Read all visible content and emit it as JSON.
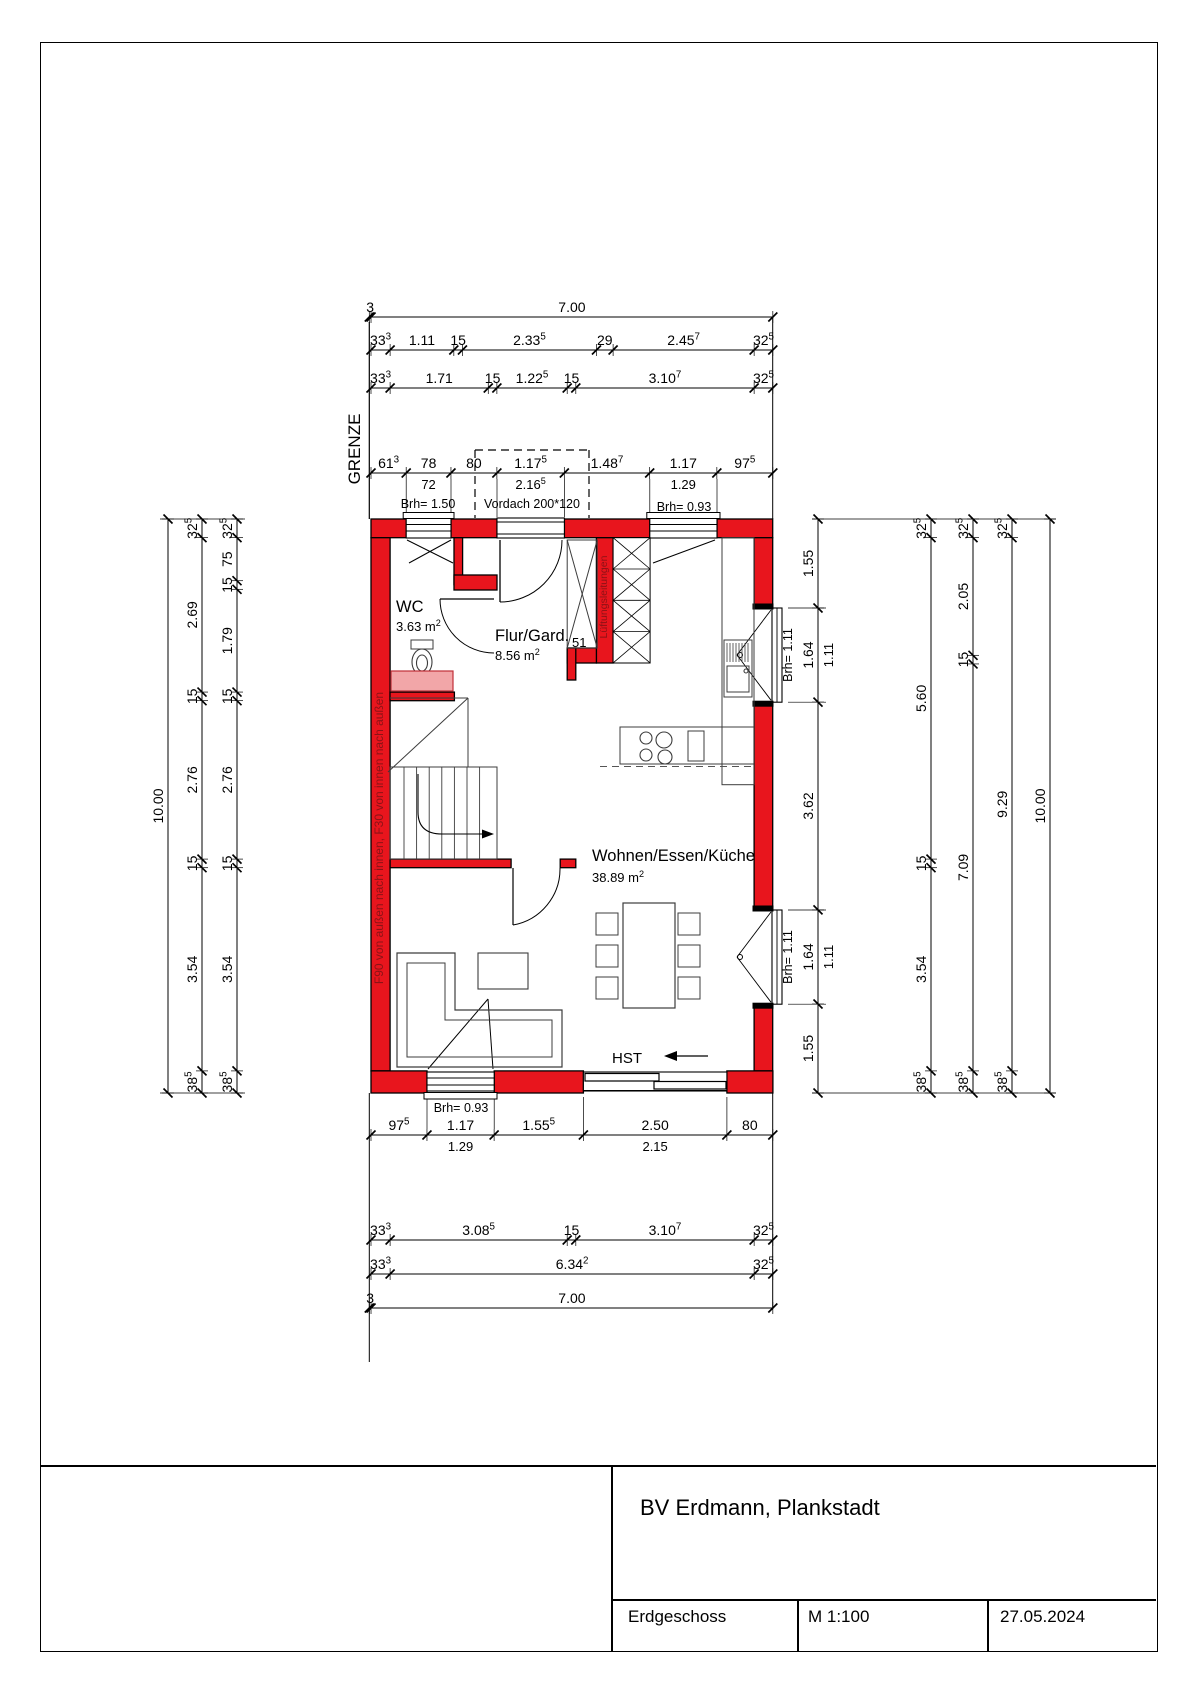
{
  "colors": {
    "wall_red": "#e8151d",
    "vanity_pink": "#f2a6a8",
    "annotation_red": "#8c1216",
    "line_black": "#000000",
    "furniture_gray": "#3c3c3c"
  },
  "floor_plan": {
    "rooms": [
      {
        "name": "WC",
        "area": "3.63 m²"
      },
      {
        "name": "Flur/Gard.",
        "area": "8.56 m²"
      },
      {
        "name": "Wohnen/Essen/Küche",
        "area": "38.89 m²"
      }
    ],
    "annotations": {
      "grenze": "GRENZE",
      "vordach": "Vordach 200*120",
      "hst": "HST",
      "gard_width": "51",
      "fire_note": "F90 von außen nach innen, F30 von innen nach außen",
      "duct_note": "Lüftungsleitungen",
      "brh_150": "Brh= 1.50",
      "brh_093_top": "Brh= 0.93",
      "brh_093_bottom": "Brh= 0.93",
      "brh_111_upper": "Brh= 1.11",
      "brh_111_lower": "Brh= 1.11"
    },
    "dimension_chains": [
      {
        "id": "T1",
        "segs": [
          {
            "t": "3",
            "v": 0.03
          },
          {
            "t": "7.00",
            "v": 7.0
          }
        ]
      },
      {
        "id": "T2",
        "segs": [
          {
            "t": "33³",
            "v": 0.333
          },
          {
            "t": "1.11",
            "v": 1.11
          },
          {
            "t": "15",
            "v": 0.15
          },
          {
            "t": "2.33⁵",
            "v": 2.335
          },
          {
            "t": "29",
            "v": 0.29
          },
          {
            "t": "2.45⁷",
            "v": 2.457
          },
          {
            "t": "32⁵",
            "v": 0.325
          }
        ]
      },
      {
        "id": "T3",
        "segs": [
          {
            "t": "33³",
            "v": 0.333
          },
          {
            "t": "1.71",
            "v": 1.71
          },
          {
            "t": "15",
            "v": 0.15
          },
          {
            "t": "1.22⁵",
            "v": 1.225
          },
          {
            "t": "15",
            "v": 0.15
          },
          {
            "t": "3.10⁷",
            "v": 3.107
          },
          {
            "t": "32⁵",
            "v": 0.325
          }
        ]
      },
      {
        "id": "T4",
        "segs": [
          {
            "t": "61³",
            "v": 0.613
          },
          {
            "t": "78",
            "v": 0.78,
            "sub": "72"
          },
          {
            "t": "80",
            "v": 0.8
          },
          {
            "t": "1.17⁵",
            "v": 1.175,
            "sub": "2.16⁵"
          },
          {
            "t": "1.48⁷",
            "v": 1.487
          },
          {
            "t": "1.17",
            "v": 1.17,
            "sub": "1.29"
          },
          {
            "t": "97⁵",
            "v": 0.975
          }
        ]
      },
      {
        "id": "B1",
        "segs": [
          {
            "t": "97⁵",
            "v": 0.975
          },
          {
            "t": "1.17",
            "v": 1.17,
            "sub": "1.29"
          },
          {
            "t": "1.55⁵",
            "v": 1.555
          },
          {
            "t": "2.50",
            "v": 2.5,
            "sub": "2.15"
          },
          {
            "t": "80",
            "v": 0.8
          }
        ]
      },
      {
        "id": "B2",
        "segs": [
          {
            "t": "33³",
            "v": 0.333
          },
          {
            "t": "3.08⁵",
            "v": 3.085
          },
          {
            "t": "15",
            "v": 0.15
          },
          {
            "t": "3.10⁷",
            "v": 3.107
          },
          {
            "t": "32⁵",
            "v": 0.325
          }
        ]
      },
      {
        "id": "B3",
        "segs": [
          {
            "t": "33³",
            "v": 0.333
          },
          {
            "t": "6.34²",
            "v": 6.342
          },
          {
            "t": "32⁵",
            "v": 0.325
          }
        ]
      },
      {
        "id": "B4",
        "segs": [
          {
            "t": "3",
            "v": 0.03
          },
          {
            "t": "7.00",
            "v": 7.0
          }
        ]
      },
      {
        "id": "L1",
        "segs": [
          {
            "t": "10.00",
            "v": 10.0
          }
        ]
      },
      {
        "id": "L2",
        "segs": [
          {
            "t": "32⁵",
            "v": 0.325
          },
          {
            "t": "2.69",
            "v": 2.69
          },
          {
            "t": "15",
            "v": 0.15
          },
          {
            "t": "2.76",
            "v": 2.76
          },
          {
            "t": "15",
            "v": 0.15
          },
          {
            "t": "3.54",
            "v": 3.54
          },
          {
            "t": "38⁵",
            "v": 0.385
          }
        ]
      },
      {
        "id": "L3",
        "segs": [
          {
            "t": "32⁵",
            "v": 0.325
          },
          {
            "t": "75",
            "v": 0.75
          },
          {
            "t": "15",
            "v": 0.15
          },
          {
            "t": "1.79",
            "v": 1.79
          },
          {
            "t": "15",
            "v": 0.15
          },
          {
            "t": "2.76",
            "v": 2.76
          },
          {
            "t": "15",
            "v": 0.15
          },
          {
            "t": "3.54",
            "v": 3.54
          },
          {
            "t": "38⁵",
            "v": 0.385
          }
        ]
      },
      {
        "id": "R1",
        "segs": [
          {
            "t": "1.55",
            "v": 1.55
          },
          {
            "t": "1.64",
            "v": 1.64,
            "sub": "1.11"
          },
          {
            "t": "3.62",
            "v": 3.62
          },
          {
            "t": "1.64",
            "v": 1.64,
            "sub": "1.11"
          },
          {
            "t": "1.55",
            "v": 1.55
          }
        ]
      },
      {
        "id": "R2",
        "segs": [
          {
            "t": "32⁵",
            "v": 0.325
          },
          {
            "t": "5.60",
            "v": 5.6
          },
          {
            "t": "15",
            "v": 0.15
          },
          {
            "t": "3.54",
            "v": 3.54
          },
          {
            "t": "38⁵",
            "v": 0.385
          }
        ]
      },
      {
        "id": "R3",
        "segs": [
          {
            "t": "32⁵",
            "v": 0.325
          },
          {
            "t": "2.05",
            "v": 2.05
          },
          {
            "t": "15",
            "v": 0.15
          },
          {
            "t": "7.09",
            "v": 7.09
          },
          {
            "t": "38⁵",
            "v": 0.385
          }
        ]
      },
      {
        "id": "R4",
        "segs": [
          {
            "t": "32⁵",
            "v": 0.325
          },
          {
            "t": "9.29",
            "v": 9.29
          },
          {
            "t": "38⁵",
            "v": 0.385
          }
        ]
      },
      {
        "id": "R5",
        "segs": [
          {
            "t": "10.00",
            "v": 10.0
          }
        ]
      }
    ]
  },
  "title_block": {
    "project": "BV Erdmann, Plankstadt",
    "sheet": "Erdgeschoss",
    "scale": "M 1:100",
    "date": "27.05.2024"
  }
}
